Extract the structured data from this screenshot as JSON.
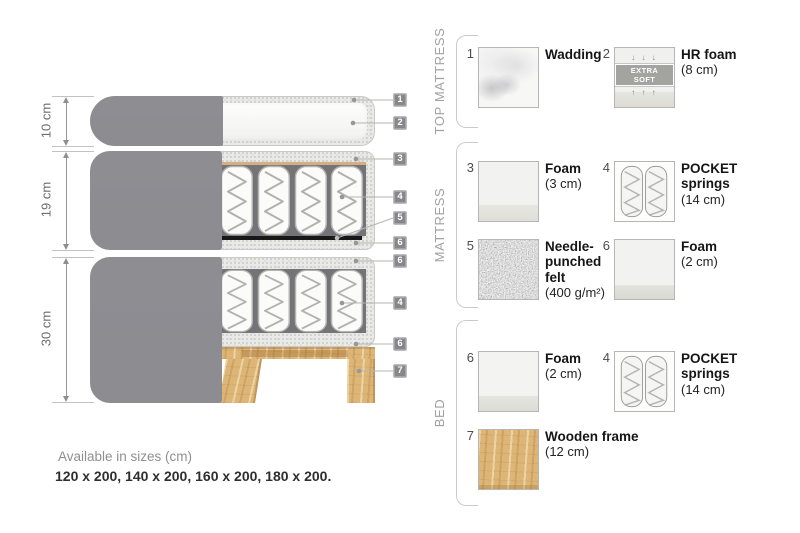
{
  "diagram": {
    "dims": [
      {
        "label": "10 cm"
      },
      {
        "label": "19 cm"
      },
      {
        "label": "30 cm"
      }
    ],
    "tags": [
      "1",
      "2",
      "3",
      "4",
      "5",
      "6",
      "6",
      "4",
      "6",
      "7"
    ],
    "sizes": {
      "title": "Available in sizes (cm)",
      "values": "120 x 200, 140 x 200, 160 x 200, 180 x 200."
    }
  },
  "legend": {
    "sections": [
      {
        "title": "TOP MATTRESS",
        "items": [
          {
            "num": "1",
            "name": "Wadding",
            "detail": ""
          },
          {
            "num": "2",
            "name": "HR foam",
            "detail": "(8 cm)",
            "badge": "EXTRA SOFT",
            "arrows_down": "↓ ↓ ↓",
            "arrows_up": "↑ ↑ ↑"
          }
        ]
      },
      {
        "title": "MATTRESS",
        "items": [
          {
            "num": "3",
            "name": "Foam",
            "detail": "(3 cm)"
          },
          {
            "num": "4",
            "name": "POCKET springs",
            "detail": "(14 cm)"
          },
          {
            "num": "5",
            "name": "Needle-punched felt",
            "detail": "(400 g/m²)"
          },
          {
            "num": "6",
            "name": "Foam",
            "detail": "(2 cm)"
          }
        ]
      },
      {
        "title": "BED",
        "items": [
          {
            "num": "6",
            "name": "Foam",
            "detail": "(2 cm)"
          },
          {
            "num": "4",
            "name": "POCKET springs",
            "detail": "(14 cm)"
          },
          {
            "num": "7",
            "name": "Wooden frame",
            "detail": "(12 cm)"
          }
        ]
      }
    ]
  },
  "colors": {
    "cover_gray": "#8c8c91",
    "casing_speckle": "#e9e9e8",
    "wood": "#ddb677",
    "felt": "#6e6e6e",
    "tag_background": "#86868b",
    "badge_background": "#a3a39f"
  }
}
